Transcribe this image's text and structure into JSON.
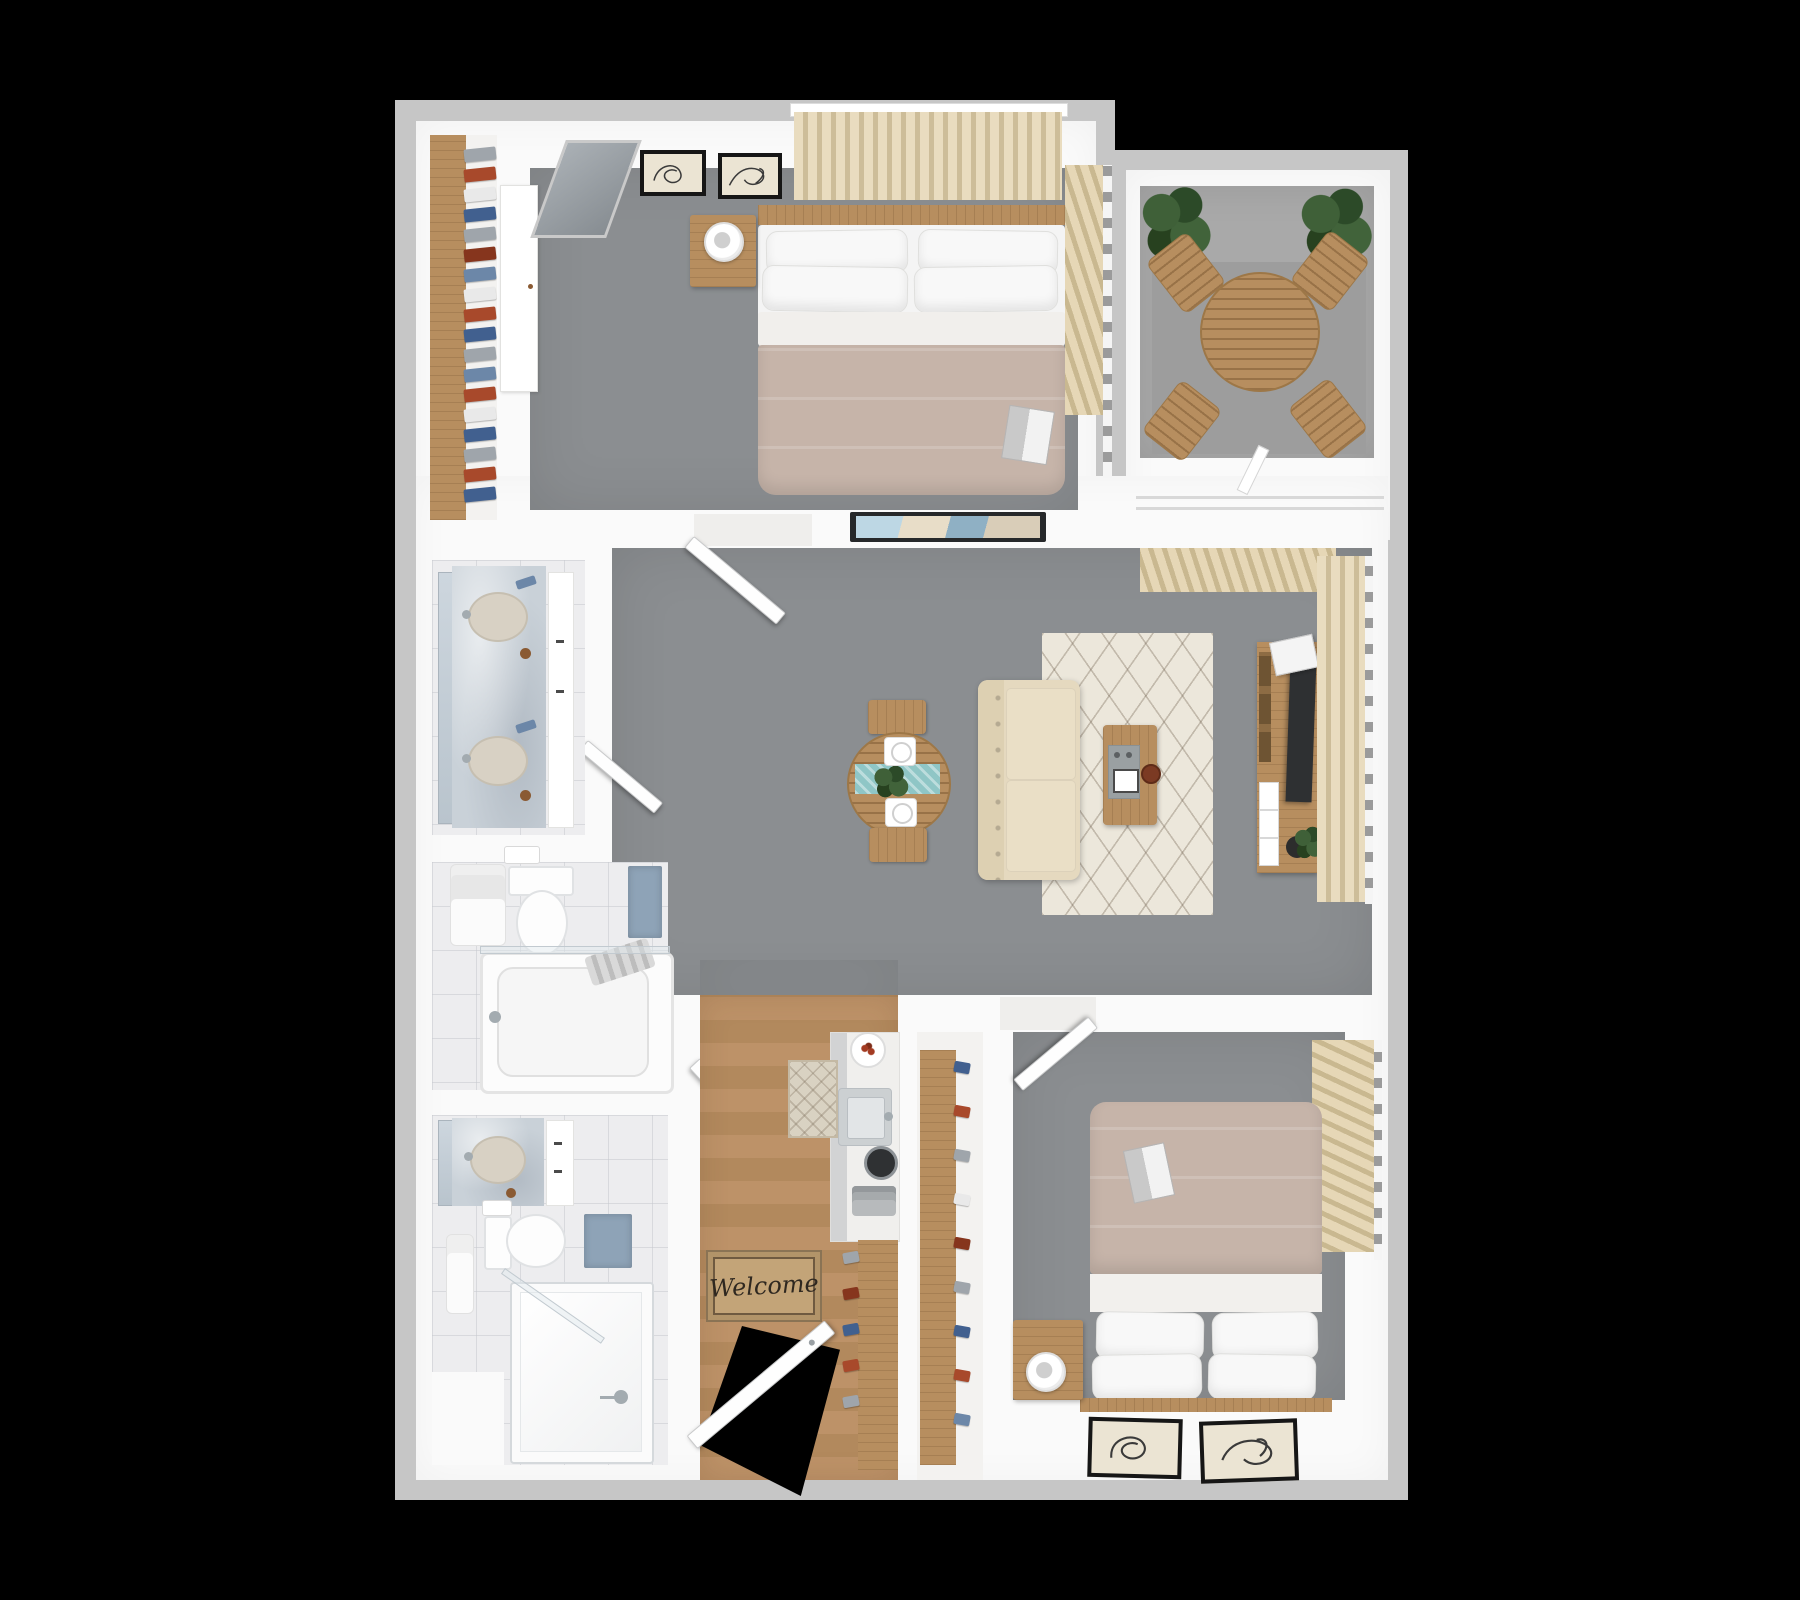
{
  "scene": {
    "description": "3D top-down floor plan render of a two-bedroom, two-bathroom apartment with private balcony, on a black background",
    "background_color": "#000000",
    "welcome_mat_text": "Welcome",
    "palette": {
      "slab_gray": "#c6c6c6",
      "wall_white": "#fafafa",
      "carpet_gray": "#8b8e91",
      "balcony_concrete": "#a9a9a9",
      "wood_furniture": "#b78e5f",
      "wood_floor": "#bb9166",
      "blanket_taupe": "#c6b4a9",
      "sofa_cream": "#e5d9bf",
      "curtain_cream": "#e6d7b6",
      "rug_cream": "#ece7db",
      "marble_blue_gray": "#c9d1d8",
      "tile_white": "#ededef",
      "teal_runner": "#8fc6c6",
      "bath_mat_blue": "#8ea3b7",
      "plant_green": "#365830",
      "shoe_navy": "#41608f",
      "shoe_rust": "#a8492b",
      "tv_dark": "#2e3032",
      "welcome_mat_tan": "#c3a478"
    },
    "rooms": [
      {
        "name": "walk-in-closet",
        "furniture": [
          "wood shelf rail",
          "hanging clothes"
        ]
      },
      {
        "name": "bedroom-1",
        "furniture": [
          "double bed with taupe blanket",
          "nightstand",
          "table lamp",
          "wardrobe",
          "leaning mirror",
          "two framed artworks",
          "window curtains top",
          "window curtains right",
          "magazine on bed"
        ]
      },
      {
        "name": "balcony",
        "furniture": [
          "round slatted table",
          "four folding chairs",
          "two potted plants",
          "sliding door handle"
        ]
      },
      {
        "name": "living-room",
        "furniture": [
          "wall-mounted tv",
          "round dining table with teal runner",
          "two dining benches",
          "two place settings",
          "centerpiece plant",
          "cream sofa",
          "patterned cream rug",
          "coffee table with tray",
          "media console with tv",
          "magazines",
          "potted plant",
          "long window curtains"
        ]
      },
      {
        "name": "bathroom-1-vanity",
        "furniture": [
          "double sink marble vanity",
          "mirror",
          "toiletries"
        ]
      },
      {
        "name": "bathroom-1",
        "furniture": [
          "toilet",
          "toilet paper holder",
          "towel rack",
          "bathtub with glass screen",
          "blue bath mat"
        ]
      },
      {
        "name": "bathroom-2",
        "furniture": [
          "single sink marble vanity",
          "toilet",
          "towel rack",
          "walk-in glass shower",
          "blue bath mat",
          "storage block"
        ]
      },
      {
        "name": "kitchen",
        "furniture": [
          "counter with sink",
          "plate of food",
          "kettle",
          "toaster",
          "small runner rug",
          "welcome mat",
          "open entry door"
        ]
      },
      {
        "name": "pantry-closet",
        "furniture": [
          "shoe shelves with shoes"
        ]
      },
      {
        "name": "bedroom-2",
        "furniture": [
          "double bed with taupe blanket",
          "nightstand",
          "table lamp",
          "two framed artworks",
          "window curtains",
          "book on bed"
        ]
      }
    ]
  }
}
